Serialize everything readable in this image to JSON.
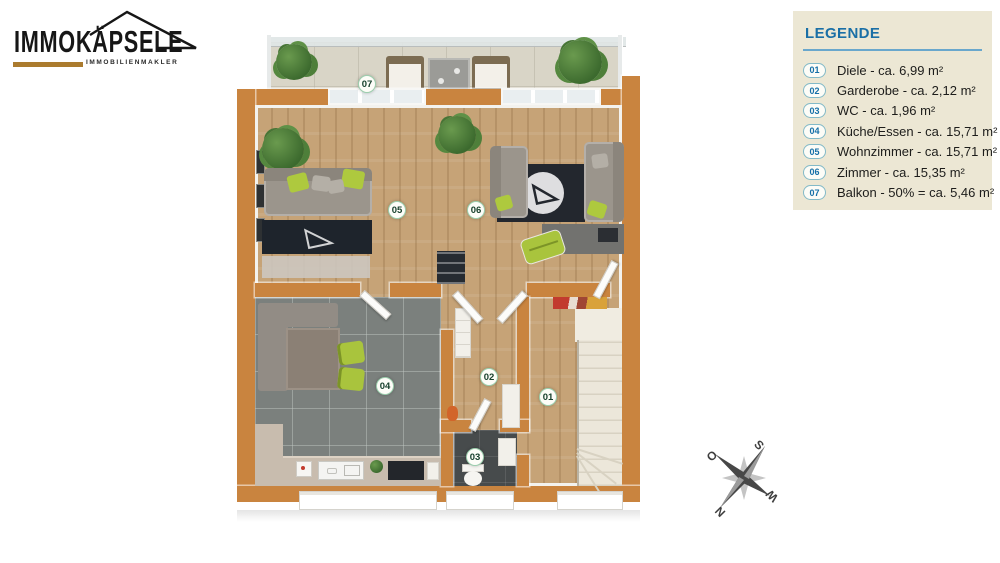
{
  "logo": {
    "brand": "IMMOKÄPSELE",
    "tagline": "IMMOBILIENMAKLER"
  },
  "legend": {
    "title": "LEGENDE",
    "items": [
      {
        "num": "01",
        "text": "Diele - ca. 6,99 m²"
      },
      {
        "num": "02",
        "text": "Garderobe - ca. 2,12 m²"
      },
      {
        "num": "03",
        "text": "WC - ca. 1,96 m²"
      },
      {
        "num": "04",
        "text": "Küche/Essen - ca. 15,71 m²"
      },
      {
        "num": "05",
        "text": "Wohnzimmer - ca. 15,71 m²"
      },
      {
        "num": "06",
        "text": "Zimmer - ca. 15,35 m²"
      },
      {
        "num": "07",
        "text": "Balkon - 50% = ca. 5,46 m²"
      }
    ]
  },
  "plan": {
    "badges": [
      {
        "label": "07"
      },
      {
        "label": "05"
      },
      {
        "label": "06"
      },
      {
        "label": "04"
      },
      {
        "label": "02"
      },
      {
        "label": "01"
      },
      {
        "label": "03"
      }
    ]
  },
  "compass": {
    "north": "N",
    "east": "O",
    "south": "S",
    "west": "W"
  },
  "colors": {
    "wall_orange": "#c9843f",
    "wood_floor": "#c6a377",
    "kitchen_tile": "#7b807d",
    "wc_tile": "#474b4c",
    "balcony_tile": "#d9d5c7",
    "accent_green": "#aec93e",
    "legend_bg": "#ece7d4",
    "legend_blue": "#1a6fa6",
    "badge_green": "#17402c",
    "logo_gold": "#ab7b2e"
  }
}
